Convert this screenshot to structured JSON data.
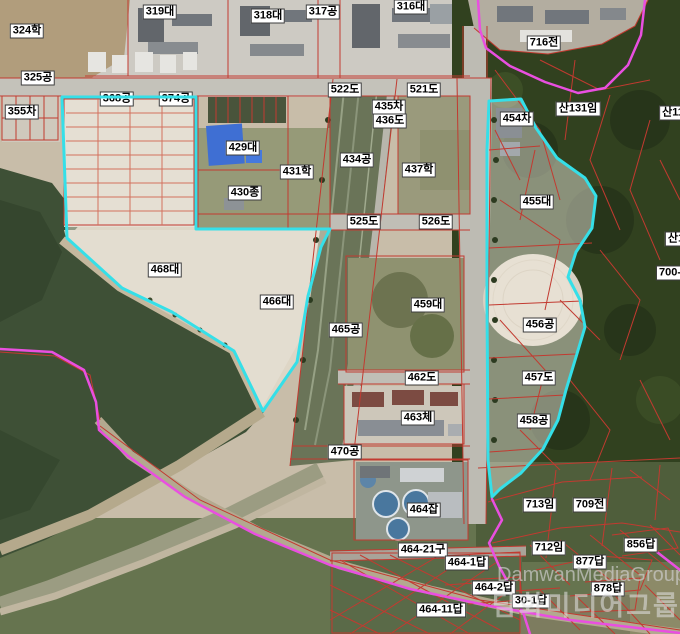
{
  "map": {
    "type": "cadastral-aerial-photo",
    "colors": {
      "highlight_cyan": "#35dfe8",
      "boundary_magenta": "#e94fe0",
      "parcel_red": "#c23a30",
      "label_bg": "#ffffff",
      "label_border": "#3c3c3c"
    },
    "labels": [
      {
        "text": "324학",
        "x": 27,
        "y": 31
      },
      {
        "text": "319대",
        "x": 160,
        "y": 12
      },
      {
        "text": "318대",
        "x": 268,
        "y": 16
      },
      {
        "text": "317공",
        "x": 323,
        "y": 12
      },
      {
        "text": "316대",
        "x": 411,
        "y": 7
      },
      {
        "text": "716전",
        "x": 544,
        "y": 43
      },
      {
        "text": "325공",
        "x": 38,
        "y": 78
      },
      {
        "text": "522도",
        "x": 345,
        "y": 90
      },
      {
        "text": "521도",
        "x": 424,
        "y": 90
      },
      {
        "text": "355차",
        "x": 22,
        "y": 112
      },
      {
        "text": "368공",
        "x": 117,
        "y": 99,
        "under": true
      },
      {
        "text": "374공",
        "x": 176,
        "y": 99,
        "under": true
      },
      {
        "text": "435차",
        "x": 389,
        "y": 107
      },
      {
        "text": "436도",
        "x": 390,
        "y": 121
      },
      {
        "text": "454차",
        "x": 517,
        "y": 119
      },
      {
        "text": "산131임",
        "x": 578,
        "y": 109
      },
      {
        "text": "산11",
        "x": 673,
        "y": 113
      },
      {
        "text": "429대",
        "x": 243,
        "y": 148
      },
      {
        "text": "434공",
        "x": 357,
        "y": 160
      },
      {
        "text": "431학",
        "x": 297,
        "y": 172
      },
      {
        "text": "437학",
        "x": 419,
        "y": 170
      },
      {
        "text": "430종",
        "x": 245,
        "y": 193
      },
      {
        "text": "525도",
        "x": 364,
        "y": 222
      },
      {
        "text": "526도",
        "x": 436,
        "y": 222
      },
      {
        "text": "455대",
        "x": 537,
        "y": 202
      },
      {
        "text": "산1",
        "x": 676,
        "y": 239
      },
      {
        "text": "468대",
        "x": 165,
        "y": 270
      },
      {
        "text": "700-",
        "x": 670,
        "y": 273
      },
      {
        "text": "466대",
        "x": 277,
        "y": 302
      },
      {
        "text": "459대",
        "x": 428,
        "y": 305
      },
      {
        "text": "456공",
        "x": 540,
        "y": 325
      },
      {
        "text": "465공",
        "x": 346,
        "y": 330
      },
      {
        "text": "457도",
        "x": 539,
        "y": 378
      },
      {
        "text": "462도",
        "x": 422,
        "y": 378
      },
      {
        "text": "463체",
        "x": 418,
        "y": 418
      },
      {
        "text": "458공",
        "x": 534,
        "y": 421
      },
      {
        "text": "470공",
        "x": 345,
        "y": 452
      },
      {
        "text": "713임",
        "x": 540,
        "y": 505
      },
      {
        "text": "709전",
        "x": 590,
        "y": 505
      },
      {
        "text": "464잡",
        "x": 424,
        "y": 510
      },
      {
        "text": "712임",
        "x": 549,
        "y": 548
      },
      {
        "text": "856답",
        "x": 641,
        "y": 545
      },
      {
        "text": "464-21구",
        "x": 423,
        "y": 550
      },
      {
        "text": "877답",
        "x": 590,
        "y": 562
      },
      {
        "text": "464-1답",
        "x": 467,
        "y": 563
      },
      {
        "text": "464-2답",
        "x": 494,
        "y": 588
      },
      {
        "text": "878답",
        "x": 608,
        "y": 589
      },
      {
        "text": "30-1답",
        "x": 531,
        "y": 601
      },
      {
        "text": "464-11답",
        "x": 441,
        "y": 610
      }
    ],
    "watermark": {
      "latin": "DamwanMediaGroup",
      "korean": "담화미디어그룹"
    }
  }
}
